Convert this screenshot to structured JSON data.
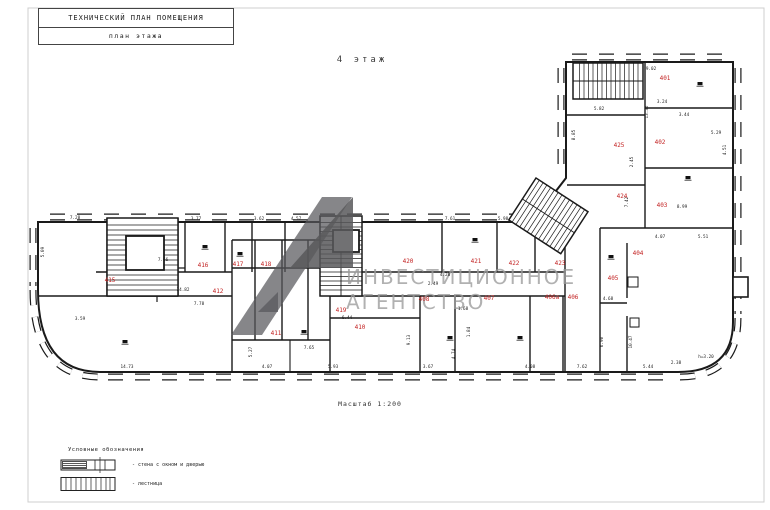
{
  "colors": {
    "room_number": "#c32222",
    "line": "#1a1a1a",
    "watermark_text": "#9c9c9c",
    "logo": "#58585b"
  },
  "title_block": {
    "line1": "ТЕХНИЧЕСКИЙ  ПЛАН ПОМЕЩЕНИЯ",
    "line2": "план этажа"
  },
  "floor_label": "4 этаж",
  "scale_label": "Масштаб 1:200",
  "watermark": {
    "line1": "ИНВЕСТИЦИОННОЕ",
    "line2": "АГЕНТСТВО"
  },
  "legend": {
    "title": "Условные обозначения",
    "items": [
      {
        "symbol": "window-wall-symbol",
        "label": "- стена с окном и дверью"
      },
      {
        "symbol": "stairs-symbol",
        "label": "- лестница"
      }
    ]
  },
  "plan": {
    "rooms": [
      {
        "number": "401",
        "x": 665,
        "y": 80
      },
      {
        "number": "402",
        "x": 660,
        "y": 144
      },
      {
        "number": "403",
        "x": 662,
        "y": 207
      },
      {
        "number": "404",
        "x": 638,
        "y": 255
      },
      {
        "number": "405",
        "x": 613,
        "y": 280
      },
      {
        "number": "406",
        "x": 573,
        "y": 299
      },
      {
        "number": "406а",
        "x": 552,
        "y": 299
      },
      {
        "number": "407",
        "x": 489,
        "y": 300
      },
      {
        "number": "408",
        "x": 424,
        "y": 301
      },
      {
        "number": "419",
        "x": 341,
        "y": 312
      },
      {
        "number": "410",
        "x": 360,
        "y": 329
      },
      {
        "number": "411",
        "x": 276,
        "y": 335
      },
      {
        "number": "412",
        "x": 218,
        "y": 293
      },
      {
        "number": "415",
        "x": 110,
        "y": 282
      },
      {
        "number": "416",
        "x": 203,
        "y": 267
      },
      {
        "number": "417",
        "x": 238,
        "y": 266
      },
      {
        "number": "418",
        "x": 266,
        "y": 266
      },
      {
        "number": "420",
        "x": 408,
        "y": 263
      },
      {
        "number": "421",
        "x": 476,
        "y": 263
      },
      {
        "number": "422",
        "x": 514,
        "y": 265
      },
      {
        "number": "423",
        "x": 560,
        "y": 265
      },
      {
        "number": "424",
        "x": 622,
        "y": 198
      },
      {
        "number": "425",
        "x": 619,
        "y": 147
      }
    ],
    "dimensions": [
      {
        "t": "9.02",
        "x": 651,
        "y": 70
      },
      {
        "t": "3.24",
        "x": 662,
        "y": 103
      },
      {
        "t": "3.44",
        "x": 684,
        "y": 116
      },
      {
        "t": "5.29",
        "x": 716,
        "y": 134
      },
      {
        "t": "4.51",
        "x": 726,
        "y": 150,
        "r": 90
      },
      {
        "t": "13.36",
        "x": 648,
        "y": 112,
        "r": 90
      },
      {
        "t": "2.45",
        "x": 633,
        "y": 162,
        "r": 90
      },
      {
        "t": "5.82",
        "x": 599,
        "y": 110
      },
      {
        "t": "8.85",
        "x": 575,
        "y": 135,
        "r": 90
      },
      {
        "t": "7.42",
        "x": 628,
        "y": 202,
        "r": 90
      },
      {
        "t": "8.99",
        "x": 682,
        "y": 208
      },
      {
        "t": "7.66",
        "x": 163,
        "y": 261
      },
      {
        "t": "7.28",
        "x": 75,
        "y": 219
      },
      {
        "t": "5.09",
        "x": 44,
        "y": 252,
        "r": 90
      },
      {
        "t": "3.77",
        "x": 196,
        "y": 220
      },
      {
        "t": "3.62",
        "x": 259,
        "y": 220
      },
      {
        "t": "4.57",
        "x": 296,
        "y": 220
      },
      {
        "t": "7.61",
        "x": 450,
        "y": 220
      },
      {
        "t": "5.98",
        "x": 503,
        "y": 220
      },
      {
        "t": "14.82",
        "x": 183,
        "y": 291
      },
      {
        "t": "7.78",
        "x": 199,
        "y": 305
      },
      {
        "t": "4.20",
        "x": 445,
        "y": 276
      },
      {
        "t": "2.49",
        "x": 433,
        "y": 285
      },
      {
        "t": "1.68",
        "x": 463,
        "y": 310
      },
      {
        "t": "1.84",
        "x": 470,
        "y": 332,
        "r": 90
      },
      {
        "t": "4.74",
        "x": 455,
        "y": 354,
        "r": 90
      },
      {
        "t": "4.08",
        "x": 530,
        "y": 368
      },
      {
        "t": "7.62",
        "x": 582,
        "y": 368
      },
      {
        "t": "7.65",
        "x": 309,
        "y": 349
      },
      {
        "t": "5.27",
        "x": 252,
        "y": 352,
        "r": 90
      },
      {
        "t": "14.73",
        "x": 127,
        "y": 368
      },
      {
        "t": "3.59",
        "x": 80,
        "y": 320
      },
      {
        "t": "4.07",
        "x": 267,
        "y": 368
      },
      {
        "t": "5.93",
        "x": 333,
        "y": 368
      },
      {
        "t": "3.67",
        "x": 428,
        "y": 368
      },
      {
        "t": "9.13",
        "x": 410,
        "y": 340,
        "r": 90
      },
      {
        "t": "5.44",
        "x": 648,
        "y": 368
      },
      {
        "t": "2.38",
        "x": 676,
        "y": 364
      },
      {
        "t": "4.07",
        "x": 660,
        "y": 238
      },
      {
        "t": "5.51",
        "x": 703,
        "y": 238
      },
      {
        "t": "6.44",
        "x": 347,
        "y": 319
      },
      {
        "t": "4.68",
        "x": 608,
        "y": 300
      },
      {
        "t": "6.90",
        "x": 603,
        "y": 342,
        "r": 90
      },
      {
        "t": "10.47",
        "x": 632,
        "y": 342,
        "r": 90
      },
      {
        "t": "h=3.20",
        "x": 706,
        "y": 358
      }
    ]
  }
}
